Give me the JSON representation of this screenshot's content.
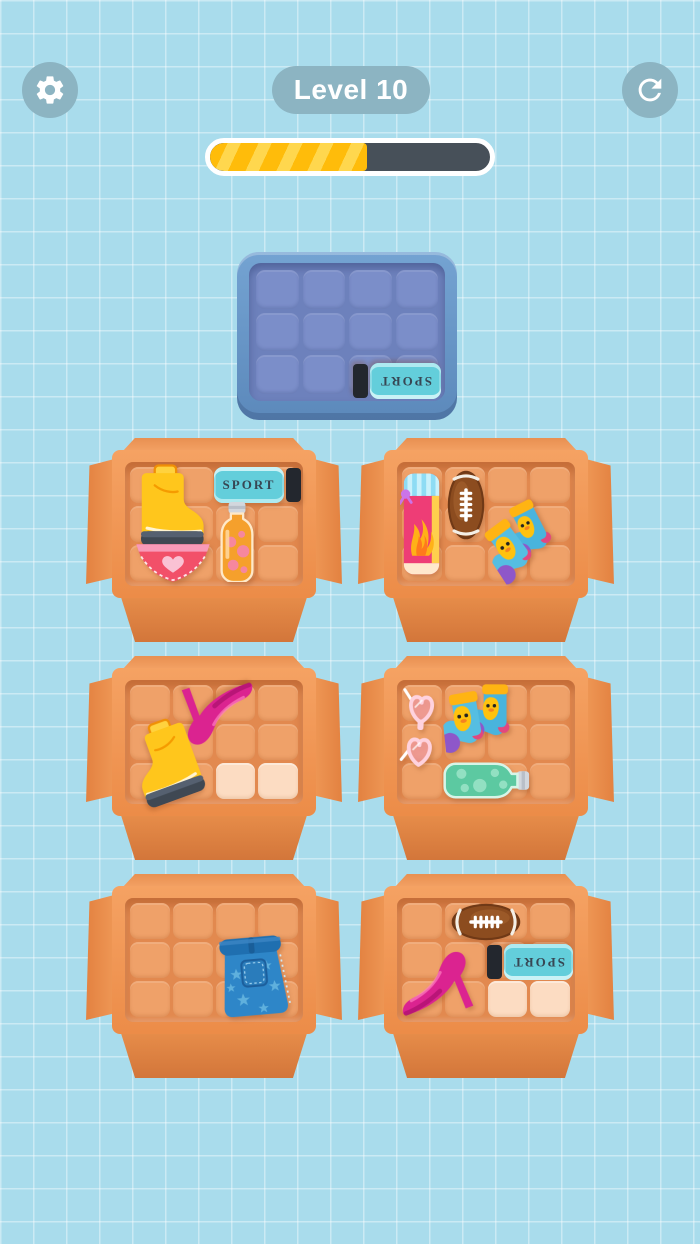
{
  "header": {
    "level_label": "Level 10",
    "settings_icon": "gear-icon",
    "restart_icon": "restart-icon"
  },
  "progress": {
    "percent": 56
  },
  "colors": {
    "background": "#a9dcec",
    "ui_button": "#8cb4c2",
    "progress_track": "#475059",
    "progress_fill": "#ffbc0a",
    "progress_fill_stripe": "#ffd74e",
    "tray_frame": "#6392c4",
    "tray_floor": "#6d81bc",
    "tray_cell": "#7b8ec9",
    "box_frame": "#f0924f",
    "box_floor": "#e2894f",
    "box_cell": "#efa169",
    "box_cell_highlight": "#fcdcc2",
    "box_front_flap": "#d9813f"
  },
  "tray": {
    "grid": {
      "rows": 3,
      "cols": 4
    },
    "items": [
      {
        "name": "sport-spray",
        "label": "SPORT",
        "row": 3,
        "col": 3,
        "span_cols": 2,
        "span_rows": 1,
        "orientation": "upside-down"
      }
    ]
  },
  "boxes": [
    {
      "id": 1,
      "position": "top-left",
      "grid": {
        "rows": 3,
        "cols": 4
      },
      "items": [
        {
          "name": "yellow-boot",
          "row": 1,
          "col": 1,
          "span_cols": 2,
          "span_rows": 2
        },
        {
          "name": "sport-spray",
          "label": "SPORT",
          "row": 1,
          "col": 3,
          "span_cols": 2,
          "span_rows": 1
        },
        {
          "name": "juice-bottle-orange",
          "row": 2,
          "col": 3,
          "span_cols": 1,
          "span_rows": 2
        },
        {
          "name": "heart-panties",
          "row": 3,
          "col": 1,
          "span_cols": 2,
          "span_rows": 1
        }
      ],
      "highlighted_cells": []
    },
    {
      "id": 2,
      "position": "top-right",
      "grid": {
        "rows": 3,
        "cols": 4
      },
      "items": [
        {
          "name": "flame-towel",
          "row": 1,
          "col": 1,
          "span_cols": 1,
          "span_rows": 3
        },
        {
          "name": "football",
          "row": 1,
          "col": 2,
          "span_cols": 1,
          "span_rows": 2
        },
        {
          "name": "duck-socks",
          "row": 2,
          "col": 3,
          "span_cols": 2,
          "span_rows": 2
        }
      ],
      "highlighted_cells": []
    },
    {
      "id": 3,
      "position": "middle-left",
      "grid": {
        "rows": 3,
        "cols": 4
      },
      "items": [
        {
          "name": "pink-heel",
          "row": 1,
          "col": 2,
          "span_cols": 2,
          "span_rows": 2
        },
        {
          "name": "yellow-boot",
          "row": 2,
          "col": 1,
          "span_cols": 2,
          "span_rows": 2
        }
      ],
      "highlighted_cells": [
        {
          "row": 3,
          "col": 3
        },
        {
          "row": 3,
          "col": 4
        }
      ]
    },
    {
      "id": 4,
      "position": "middle-right",
      "grid": {
        "rows": 3,
        "cols": 4
      },
      "items": [
        {
          "name": "heart-glasses",
          "row": 1,
          "col": 1,
          "span_cols": 1,
          "span_rows": 2
        },
        {
          "name": "duck-socks",
          "row": 1,
          "col": 2,
          "span_cols": 2,
          "span_rows": 2
        },
        {
          "name": "soda-bottle-green",
          "row": 3,
          "col": 2,
          "span_cols": 2,
          "span_rows": 1
        }
      ],
      "highlighted_cells": []
    },
    {
      "id": 5,
      "position": "bottom-left",
      "grid": {
        "rows": 3,
        "cols": 4
      },
      "items": [
        {
          "name": "jean-shorts",
          "row": 2,
          "col": 3,
          "span_cols": 2,
          "span_rows": 2
        }
      ],
      "highlighted_cells": []
    },
    {
      "id": 6,
      "position": "bottom-right",
      "grid": {
        "rows": 3,
        "cols": 4
      },
      "items": [
        {
          "name": "football",
          "row": 1,
          "col": 2,
          "span_cols": 2,
          "span_rows": 1
        },
        {
          "name": "sport-spray",
          "label": "SPORT",
          "row": 2,
          "col": 3,
          "span_cols": 2,
          "span_rows": 1,
          "orientation": "upside-down"
        },
        {
          "name": "pink-heel",
          "row": 2,
          "col": 1,
          "span_cols": 2,
          "span_rows": 2
        }
      ],
      "highlighted_cells": [
        {
          "row": 3,
          "col": 3
        },
        {
          "row": 3,
          "col": 4
        }
      ]
    }
  ]
}
